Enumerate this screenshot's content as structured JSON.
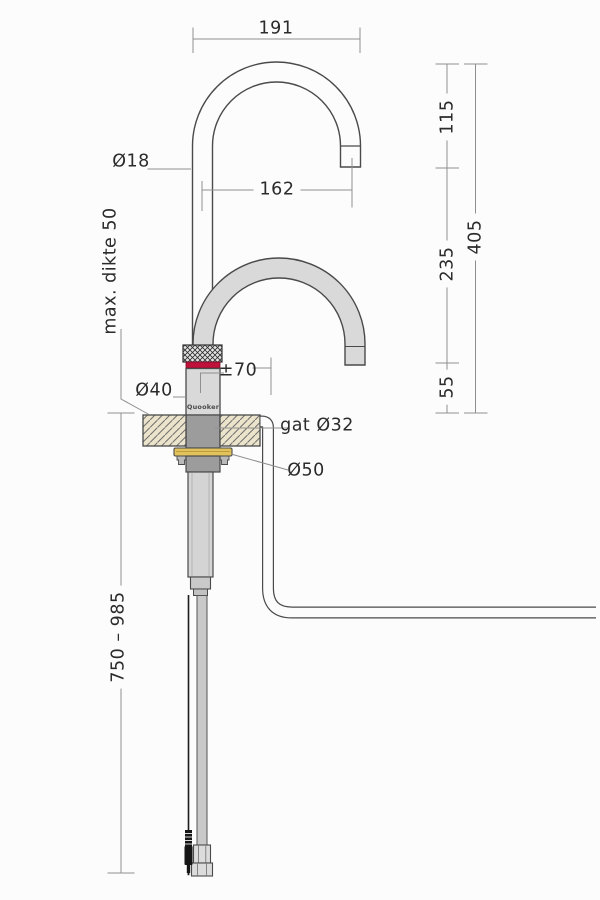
{
  "drawing": {
    "title": "tap-installation-dimension-drawing",
    "logo": "Quooker",
    "dimensions": {
      "top_width": "191",
      "spout_reach": "162",
      "spout_drop": "115",
      "mid_height": "235",
      "base_height": "55",
      "total_height": "405",
      "spout_diameter": "Ø18",
      "max_thickness": "max. dikte 50",
      "height_adjust": "±70",
      "body_diameter": "Ø40",
      "hole_diameter": "gat Ø32",
      "washer_diameter": "Ø50",
      "below_counter_range": "750 – 985"
    },
    "colors": {
      "accent_red": "#bf1139",
      "brass": "#e2c35b",
      "counter_beige": "#ece3cb",
      "steel_gray": "#d9d9d9",
      "outline": "#4a4a4a",
      "dimension_line": "#8f8f8f"
    }
  }
}
